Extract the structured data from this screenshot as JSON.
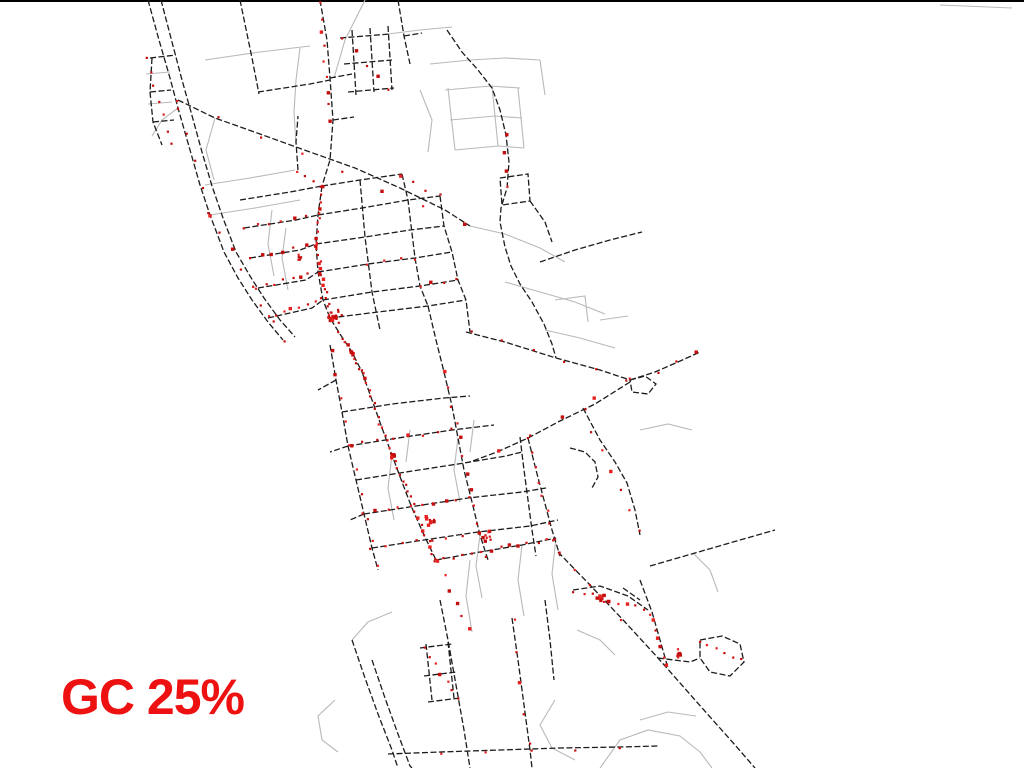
{
  "page": {
    "background": "#ffffff",
    "top_border_color": "#000000"
  },
  "label": {
    "text": "GC 25%",
    "color": "#ee1111"
  },
  "map": {
    "width": 1024,
    "height": 768,
    "colors": {
      "road_major": "#1c1c1c",
      "road_minor": "#b9b9b9",
      "point_dark": "#c40d0d",
      "point_bright": "#e62020"
    },
    "roads_major": [
      "148,0 159,40 170,78 178,108 190,150 200,185 210,215 224,252 238,278 252,300 268,322 283,340",
      "161,0 172,42 182,80 191,112 202,152 212,186 223,218 236,252 250,276 264,298 280,320 295,337",
      "152,58 150,92 153,122 162,145",
      "150,92 171,90",
      "153,122 174,120",
      "150,58 176,55",
      "240,0 252,58 259,94",
      "320,0 327,40 330,78 333,120 330,160 322,186",
      "333,120 354,117",
      "352,30 356,95",
      "370,28 374,92",
      "388,26 392,90",
      "340,38 390,34",
      "344,64 392,60",
      "348,92 394,88",
      "398,0 404,36 410,64",
      "404,36 422,33",
      "447,30 462,52 478,70 492,88 500,110 506,135 509,162 507,188 501,208 500,222 505,247 511,266 520,284 532,302 544,324 552,344 556,358",
      "258,92 310,84 330,80",
      "178,100 215,118 260,134 310,152 355,168 400,188 445,210 470,226",
      "322,186 318,215 316,244 318,272 323,300 330,318 340,334 352,352 362,372",
      "240,200 290,192 322,186",
      "244,228 296,220 318,215",
      "250,258 300,250 316,244",
      "258,288 306,280 318,272",
      "268,318 312,308 323,300",
      "322,186 360,180 402,174",
      "318,215 362,208 408,200 440,196",
      "316,244 365,237 410,230 444,226",
      "318,272 368,264 415,258 452,252",
      "323,300 372,292 420,286 458,280",
      "330,318 378,312 428,306 466,300",
      "360,180 365,237 372,292 380,330",
      "402,174 408,200 415,258 420,286 428,306",
      "440,196 444,226 452,252 458,280 466,300 470,332",
      "466,332 505,342 556,358 600,370 630,380",
      "630,380 655,372 678,362 700,352",
      "630,380 645,376 656,384 648,394 632,392 630,380",
      "630,382 595,404 560,421 528,438 497,452 470,462",
      "362,372 372,400 382,428 392,455 402,482 412,508 424,535 436,560",
      "330,345 336,380 342,412 348,446 356,480 364,514 372,548 378,570",
      "428,306 436,340 444,372 452,406 458,438 464,470 472,502 480,535 488,560",
      "342,412 392,404 444,398 470,396",
      "348,446 398,438 452,430 494,425",
      "356,480 406,472 458,464 506,456 522,452",
      "364,514 416,506 468,498 522,492 546,488",
      "372,548 424,540 478,532 530,526 558,520",
      "436,560 480,552 522,545 556,538",
      "520,437 524,470 528,500 532,530 536,556",
      "583,408 600,440 615,462 627,483 635,510 640,535",
      "528,438 536,470 544,500 552,530 560,556",
      "570,448 585,452 595,462 598,477 592,488",
      "558,552 590,585 625,622 658,658 695,700 735,745 755,768",
      "352,640 365,678 378,714 392,750 398,768",
      "372,660 385,698 398,734 410,766 412,768",
      "440,600 448,640 456,685 464,730 470,768",
      "512,618 518,660 524,705 530,750 532,768",
      "420,648 452,644",
      "424,676 456,672",
      "428,702 460,698",
      "426,644 432,700",
      "448,642 454,698",
      "388,754 440,752 500,750 560,748 620,747 658,746",
      "573,590 600,586 628,596 648,610",
      "640,580 652,612 660,640 668,668",
      "700,640 722,636 740,644 744,662 730,676 710,672 700,658 700,640",
      "658,658 690,662 700,658",
      "650,566 695,553 740,540 775,530",
      "500,178 528,174 530,201 502,205 500,178",
      "530,201 545,222 552,242",
      "540,262 575,250 610,240 642,232",
      "336,380 318,390",
      "348,446 330,452",
      "364,514 350,520",
      "298,170 296,142 298,116",
      "545,600 550,640 554,680",
      "623,588 640,600",
      "330,78 352,74"
    ],
    "roads_minor": [
      "205,60 260,52 310,46",
      "365,0 345,40 334,78",
      "430,64 470,60 505,58 540,60",
      "540,60 545,95",
      "448,88 455,150",
      "492,86 498,146",
      "518,88 524,148",
      "445,90 490,86 520,88",
      "450,120 495,116 522,118",
      "455,150 498,146 524,148",
      "205,185 250,178 295,170",
      "210,215 255,208 300,200",
      "146,74 170,72",
      "148,104 172,102",
      "178,108 162,120 152,136",
      "300,48 296,80 294,112 296,145",
      "272,210 268,244 274,276",
      "286,228 282,258 288,290",
      "470,226 505,234 540,248 565,262",
      "505,282 540,292 575,302 605,314",
      "545,330 580,338 615,348",
      "555,300 585,296 588,322",
      "600,320 628,316",
      "392,455 388,488 394,520",
      "458,438 454,470 460,502",
      "410,430 406,462",
      "474,420 470,452",
      "480,535 476,566 482,598",
      "470,560 466,596 472,632",
      "522,545 518,580 524,616",
      "556,538 552,574 558,610",
      "335,700 318,716 322,740 338,752",
      "555,700 540,725 552,748 575,760",
      "600,768 620,740 648,730 680,736 700,752 712,768",
      "640,720 668,712 696,716",
      "693,553 710,570 718,592",
      "577,630 600,640 615,655",
      "640,430 668,424 692,430",
      "940,5 1012,8",
      "388,34 420,30 452,27",
      "392,612 368,622 352,640",
      "420,90 432,120 428,152",
      "215,118 206,150 214,180"
    ],
    "point_runs": [
      {
        "f": [
          322,
          188
        ],
        "t": [
          317,
          245
        ],
        "n": 9
      },
      {
        "f": [
          317,
          245
        ],
        "t": [
          330,
          318
        ],
        "n": 16
      },
      {
        "f": [
          340,
          334
        ],
        "t": [
          362,
          372
        ],
        "n": 10
      },
      {
        "f": [
          362,
          372
        ],
        "t": [
          392,
          455
        ],
        "n": 14
      },
      {
        "f": [
          392,
          455
        ],
        "t": [
          436,
          560
        ],
        "n": 18
      },
      {
        "f": [
          436,
          560
        ],
        "t": [
          556,
          538
        ],
        "n": 14
      },
      {
        "f": [
          348,
          446
        ],
        "t": [
          452,
          430
        ],
        "n": 8
      },
      {
        "f": [
          364,
          514
        ],
        "t": [
          468,
          498
        ],
        "n": 10
      },
      {
        "f": [
          372,
          548
        ],
        "t": [
          478,
          532
        ],
        "n": 8
      },
      {
        "f": [
          332,
          352
        ],
        "t": [
          376,
          566
        ],
        "n": 10
      },
      {
        "f": [
          444,
          372
        ],
        "t": [
          486,
          556
        ],
        "n": 12
      },
      {
        "f": [
          244,
          228
        ],
        "t": [
          318,
          215
        ],
        "n": 7
      },
      {
        "f": [
          250,
          258
        ],
        "t": [
          316,
          244
        ],
        "n": 7
      },
      {
        "f": [
          258,
          288
        ],
        "t": [
          318,
          272
        ],
        "n": 8
      },
      {
        "f": [
          268,
          318
        ],
        "t": [
          323,
          300
        ],
        "n": 8
      },
      {
        "f": [
          210,
          215
        ],
        "t": [
          283,
          340
        ],
        "n": 8
      },
      {
        "f": [
          178,
          108
        ],
        "t": [
          210,
          215
        ],
        "n": 5
      },
      {
        "f": [
          320,
          4
        ],
        "t": [
          331,
          120
        ],
        "n": 9
      },
      {
        "f": [
          146,
          58
        ],
        "t": [
          170,
          145
        ],
        "n": 7
      },
      {
        "f": [
          178,
          100
        ],
        "t": [
          466,
          226
        ],
        "n": 8
      },
      {
        "f": [
          505,
          135
        ],
        "t": [
          507,
          188
        ],
        "n": 4
      },
      {
        "f": [
          470,
          332
        ],
        "t": [
          628,
          379
        ],
        "n": 6
      },
      {
        "f": [
          497,
          451
        ],
        "t": [
          626,
          382
        ],
        "n": 5
      },
      {
        "f": [
          528,
          438
        ],
        "t": [
          558,
          553
        ],
        "n": 9
      },
      {
        "f": [
          584,
          410
        ],
        "t": [
          638,
          532
        ],
        "n": 7
      },
      {
        "f": [
          560,
          554
        ],
        "t": [
          622,
          620
        ],
        "n": 5
      },
      {
        "f": [
          574,
          591
        ],
        "t": [
          646,
          609
        ],
        "n": 9
      },
      {
        "f": [
          652,
          613
        ],
        "t": [
          667,
          666
        ],
        "n": 7
      },
      {
        "f": [
          700,
          642
        ],
        "t": [
          742,
          660
        ],
        "n": 6
      },
      {
        "f": [
          438,
          562
        ],
        "t": [
          468,
          630
        ],
        "n": 6
      },
      {
        "f": [
          514,
          620
        ],
        "t": [
          529,
          745
        ],
        "n": 5
      },
      {
        "f": [
          424,
          648
        ],
        "t": [
          458,
          700
        ],
        "n": 7
      },
      {
        "f": [
          344,
          40
        ],
        "t": [
          390,
          88
        ],
        "n": 5
      },
      {
        "f": [
          402,
          176
        ],
        "t": [
          440,
          196
        ],
        "n": 4
      },
      {
        "f": [
          442,
          754
        ],
        "t": [
          618,
          748
        ],
        "n": 5
      },
      {
        "f": [
          657,
          371
        ],
        "t": [
          698,
          353
        ],
        "n": 3
      },
      {
        "f": [
          420,
          286
        ],
        "t": [
          458,
          280
        ],
        "n": 4
      },
      {
        "f": [
          368,
          264
        ],
        "t": [
          415,
          258
        ],
        "n": 4
      },
      {
        "f": [
          296,
          170
        ],
        "t": [
          322,
          186
        ],
        "n": 4
      }
    ],
    "point_clusters": [
      {
        "cx": 333,
        "cy": 317,
        "r": 9,
        "n": 24
      },
      {
        "cx": 300,
        "cy": 258,
        "r": 5,
        "n": 6
      },
      {
        "cx": 488,
        "cy": 536,
        "r": 6,
        "n": 8
      },
      {
        "cx": 392,
        "cy": 455,
        "r": 5,
        "n": 8
      },
      {
        "cx": 602,
        "cy": 598,
        "r": 6,
        "n": 8
      },
      {
        "cx": 680,
        "cy": 655,
        "r": 7,
        "n": 8
      },
      {
        "cx": 430,
        "cy": 520,
        "r": 6,
        "n": 8
      },
      {
        "cx": 352,
        "cy": 352,
        "r": 5,
        "n": 8
      }
    ]
  }
}
